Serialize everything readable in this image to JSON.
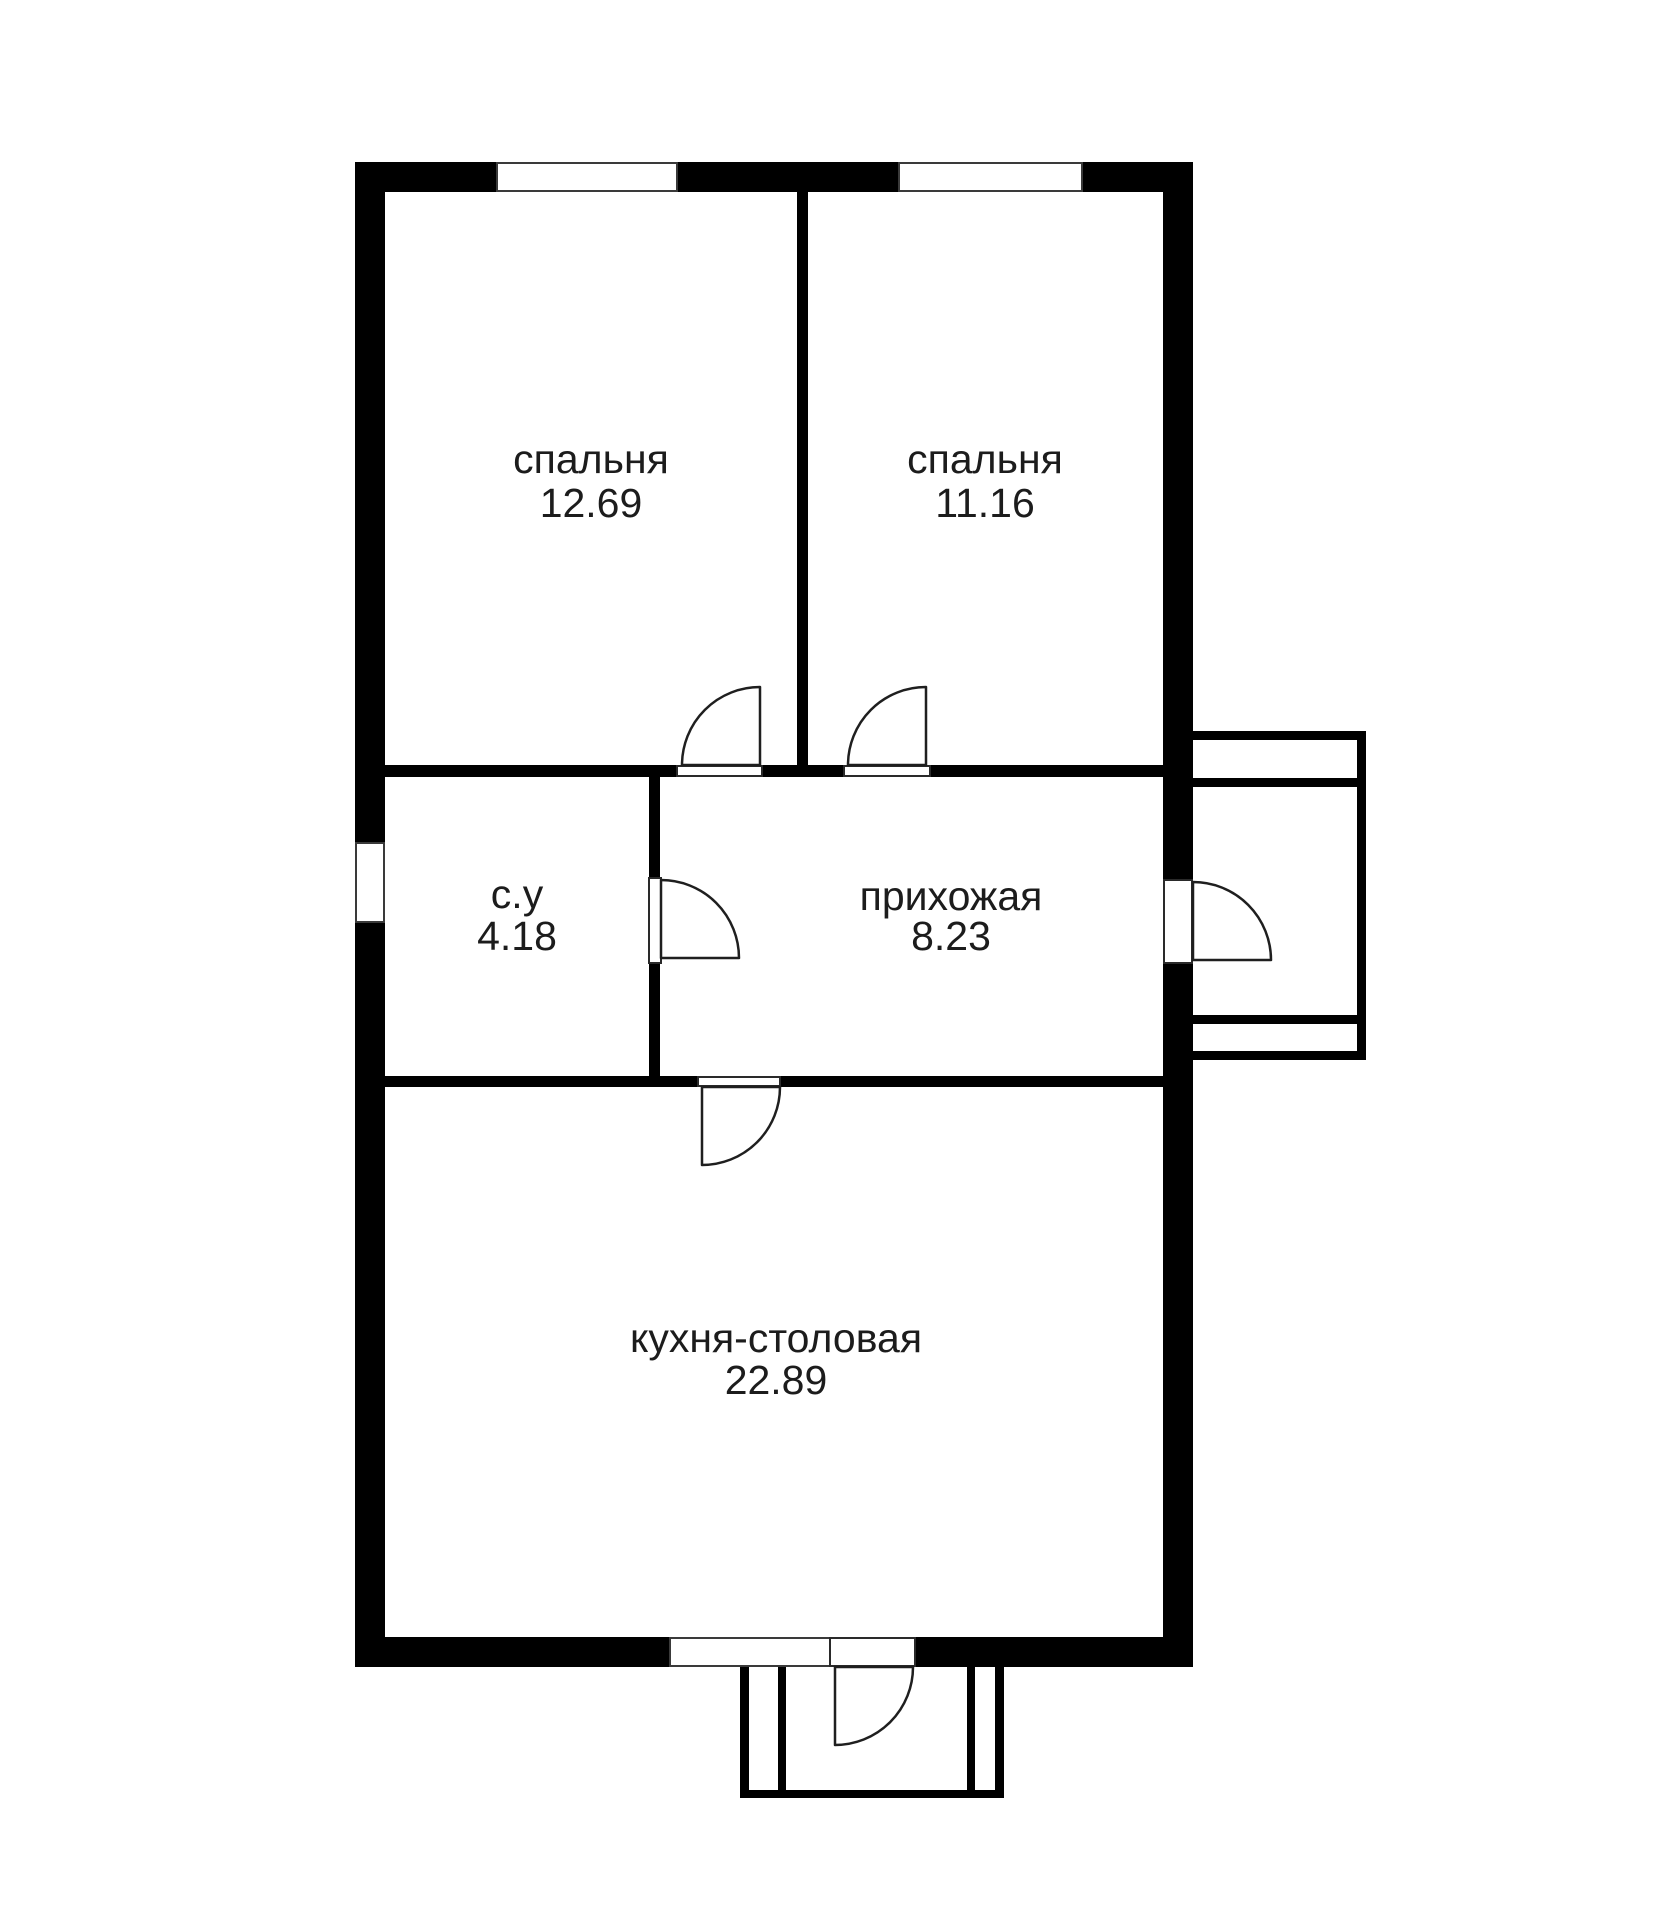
{
  "page": {
    "background": "#ffffff"
  },
  "plan": {
    "type": "floor-plan",
    "language": "ru",
    "colors": {
      "wall": "#000000",
      "line": "#1f1f1f",
      "text": "#1c1c1c",
      "background": "#ffffff"
    },
    "rooms": [
      {
        "id": "bedroom-1",
        "label": "спальня",
        "area": "12.69"
      },
      {
        "id": "bedroom-2",
        "label": "спальня",
        "area": "11.16"
      },
      {
        "id": "bathroom",
        "label": "с.у",
        "area": "4.18"
      },
      {
        "id": "hallway",
        "label": "прихожая",
        "area": "8.23"
      },
      {
        "id": "kitchen-dining",
        "label": "кухня-столовая",
        "area": "22.89"
      }
    ],
    "window_count": 4,
    "door_count": 6,
    "porch_count": 2
  }
}
